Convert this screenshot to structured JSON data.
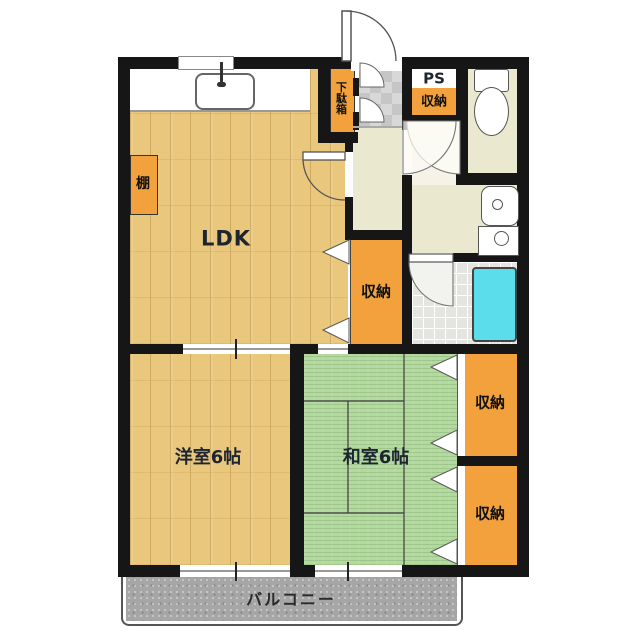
{
  "floorplan": {
    "rooms": {
      "ldk": {
        "label": "LDK"
      },
      "western_room": {
        "label": "洋室6帖"
      },
      "japanese_room": {
        "label": "和室6帖"
      }
    },
    "storage": {
      "entry_storage": {
        "label": "収納"
      },
      "ldk_closet": {
        "label": "収納"
      },
      "tatami_closet_upper": {
        "label": "収納"
      },
      "tatami_closet_lower": {
        "label": "収納"
      },
      "shoe_cabinet": {
        "label": "下駄箱"
      },
      "shelf": {
        "label": "棚"
      }
    },
    "utility": {
      "pipe_space": {
        "label": "PS"
      }
    },
    "balcony": {
      "label": "バルコニー"
    },
    "colors": {
      "wall": "#161616",
      "wood_floor": "#E9C77C",
      "tatami_floor": "#B4D9A0",
      "closet_orange": "#F2A13C",
      "hallway_cream": "#EBE8D0",
      "bathtub_cyan": "#5BDDEB",
      "balcony_gray": "#A6A6A6",
      "label_text": "#1D2531"
    }
  }
}
